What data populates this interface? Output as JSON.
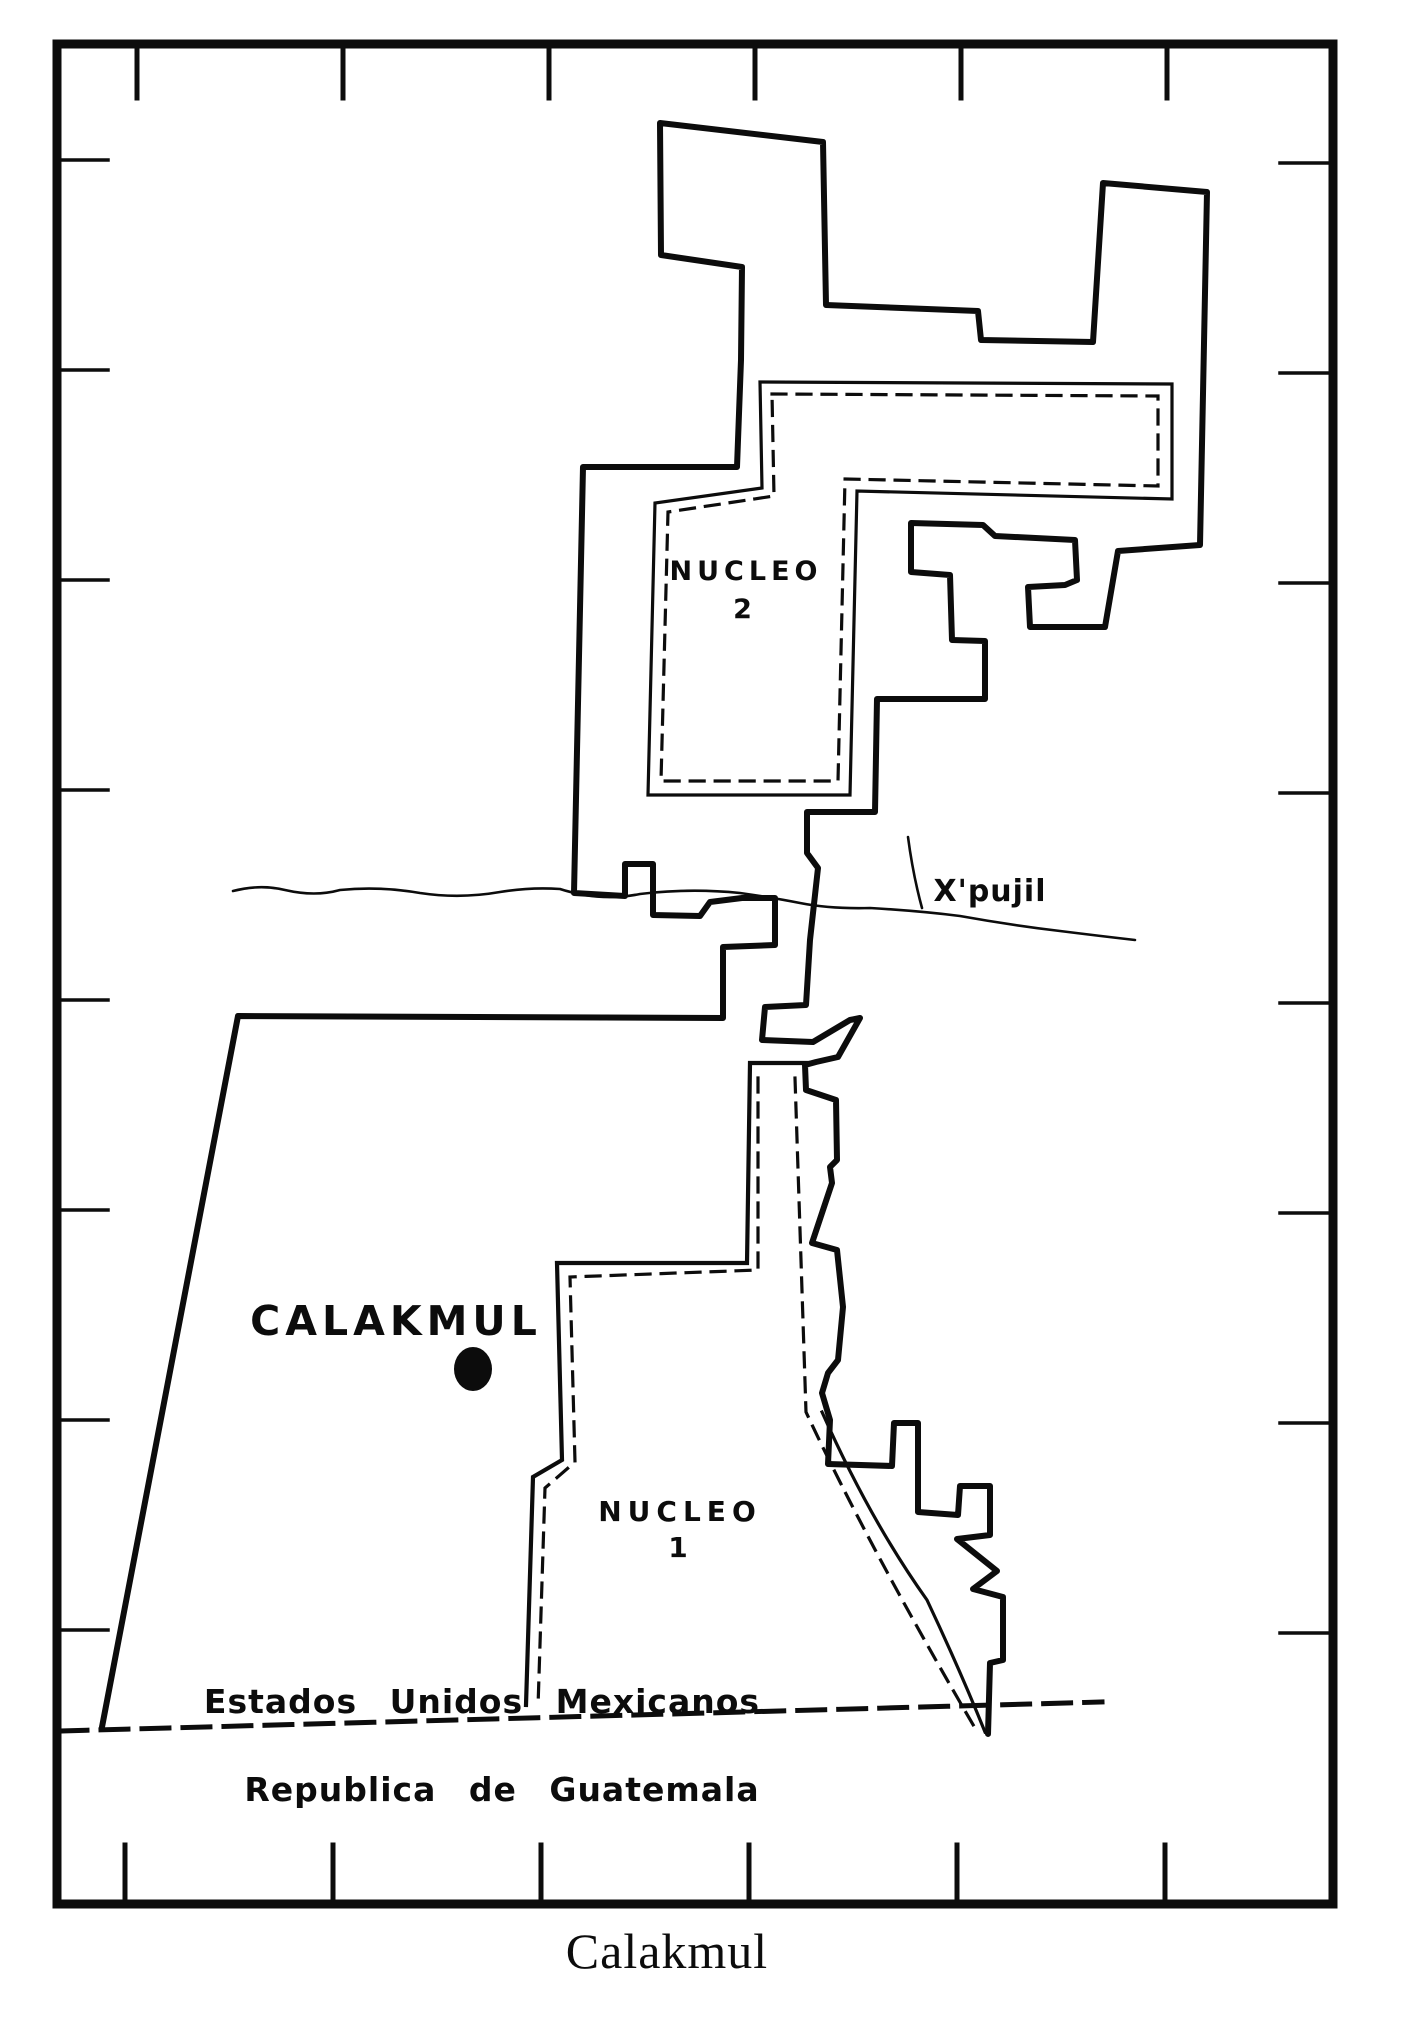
{
  "map": {
    "caption": "Calakmul",
    "colors": {
      "ink": "#0c0c0c",
      "paper": "#ffffff"
    },
    "region_labels": {
      "nucleo2_line1": "NUCLEO",
      "nucleo2_line2": "2",
      "nucleo1_line1": "NUCLEO",
      "nucleo1_line2": "1"
    },
    "place_labels": {
      "calakmul": "CALAKMUL",
      "xpujil": "X'pujil"
    },
    "border_labels": {
      "mexico": "Estados Unidos Mexicanos",
      "guatemala": "Republica de Guatemala"
    },
    "site_dot": {
      "cx": "473",
      "cy": "1369",
      "rx": "19",
      "ry": "22"
    },
    "paths": {
      "frame": "M57,44 H1333 V1904 H57 Z",
      "ticks_top": "M137,48 v50 M343,48 v50 M549,48 v50 M755,48 v50 M961,48 v50 M1167,48 v50",
      "ticks_bottom": "M125,1900 v-55 M333,1900 v-55 M541,1900 v-55 M749,1900 v-55 M957,1900 v-55 M1165,1900 v-55",
      "ticks_left": "M62,160 h46 M62,370 h46 M62,580 h46 M62,790 h46 M62,1000 h46 M62,1210 h46 M62,1420 h46 M62,1630 h46",
      "ticks_right": "M1328,163 h-48 M1328,373 h-48 M1328,583 h-48 M1328,793 h-48 M1328,1003 h-48 M1328,1213 h-48 M1328,1423 h-48 M1328,1633 h-48",
      "main_boundary": "M102,1727 L238,1016 L723,1018 L723,947 L775,945 L775,898 L742,898 L710,902 L700,916 L653,915 L653,864 L625,864 L625,896 L574,893 L583,467 L737,467 L741,360 L742,267 L661,255 L660,123 L823,142 L826,305 L978,311 L981,340 L1093,342 L1103,183 L1207,192 L1200,545 L1118,551 L1105,627 L1030,627 L1028,587 L1065,585 L1077,580 L1075,540 L995,536 L983,525 L911,523 L911,572 L950,575 L952,640 L985,641 L985,699 L877,699 L875,812 L807,812 L807,853 L818,868 L810,940 L806,1005 L765,1007 L762,1040 L813,1042 L850,1020 L860,1018 L838,1057 L816,1062 L805,1065 L806,1090 L836,1100 L837,1160 L830,1167 L832,1183 L812,1243 L837,1250 L843,1307 L838,1360 L828,1373 L822,1393 L830,1420 L828,1464 L892,1466 L894,1423 L918,1423 L918,1512 L958,1515 L960,1486 L990,1486 L990,1535 L957,1539 L997,1571 L973,1589 L1003,1597 L1003,1660 L990,1663 L988,1734",
      "nucleo2_outline": "M760,382 L1172,384 L1172,499 L857,491 L850,795 L648,795 L655,503 L762,488 Z",
      "nucleo2_dashed": "M772,394 L1158,396 L1158,486 L845,479 L838,781 L661,781 L668,512 L774,496 Z",
      "nucleo1_outline": "M813,1063 L750,1063 L747,1263 L557,1263 L562,1460 L533,1477 L526,1705",
      "nucleo1_diagonal": "M822,1412 Q870,1520 927,1600 Q960,1670 985,1732",
      "nucleo1_dashed": "M758,1078 L758,1270 L570,1277 L575,1462 L545,1488 L538,1707",
      "nucleo1_dashed_east": "M795,1078 L806,1412 Q868,1545 975,1728",
      "intl_border": "M60,1731 L1102,1702",
      "road": "M233,891 Q260,884 285,890 Q315,897 340,890 Q380,886 420,893 Q460,899 500,892 Q530,887 560,889 Q600,902 640,894 Q690,888 740,893 Q775,898 800,903 Q830,909 870,908 Q920,911 960,916 Q1010,925 1060,931 Q1100,936 1135,940",
      "xpujil_tick": "M908,837 Q913,875 922,908"
    }
  }
}
